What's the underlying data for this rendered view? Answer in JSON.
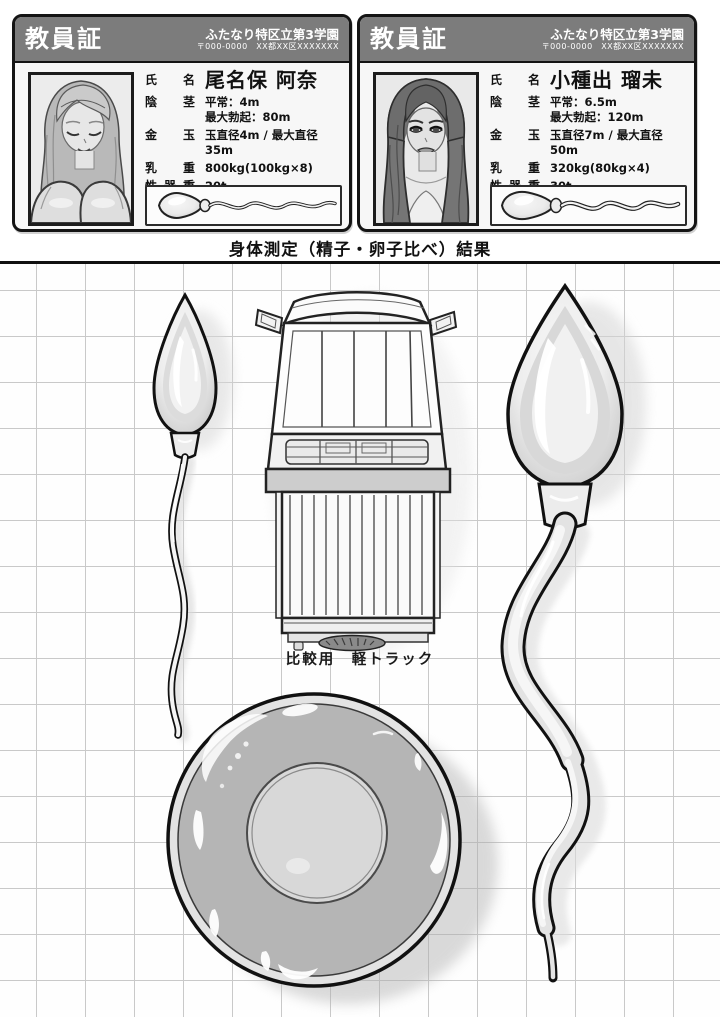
{
  "section_title": "身体測定（精子・卵子比べ）結果",
  "cards": [
    {
      "title": "教員証",
      "school": "ふたなり特区立第3学園",
      "address": "〒000-0000　XX都XX区XXXXXXX",
      "name_label": "氏名",
      "name": "尾名保 阿奈",
      "fields": [
        {
          "label": "陰茎",
          "value": "平常：4m\n最大勃起：80m"
        },
        {
          "label": "金玉",
          "value": "玉直径4m / 最大直径35m"
        },
        {
          "label": "乳重",
          "value": "800kg(100kg×8)"
        },
        {
          "label": "性器重",
          "value": "20t"
        },
        {
          "label": "精子",
          "value": "4m"
        }
      ]
    },
    {
      "title": "教員証",
      "school": "ふたなり特区立第3学園",
      "address": "〒000-0000　XX都XX区XXXXXXX",
      "name_label": "氏名",
      "name": "小種出 瑠未",
      "fields": [
        {
          "label": "陰茎",
          "value": "平常：6.5m\n最大勃起：120m"
        },
        {
          "label": "金玉",
          "value": "玉直径7m / 最大直径50m"
        },
        {
          "label": "乳重",
          "value": "320kg(80kg×4)"
        },
        {
          "label": "性器重",
          "value": "30t"
        },
        {
          "label": "精子",
          "value": "7m"
        }
      ]
    }
  ],
  "diagram": {
    "truck_label": "比較用　軽トラック"
  },
  "colors": {
    "card_header": "#7c7c7c",
    "card_border": "#141414",
    "grid_line": "#c9c9c9",
    "dish_body": "#b5b5b5",
    "paper": "#ffffff"
  }
}
